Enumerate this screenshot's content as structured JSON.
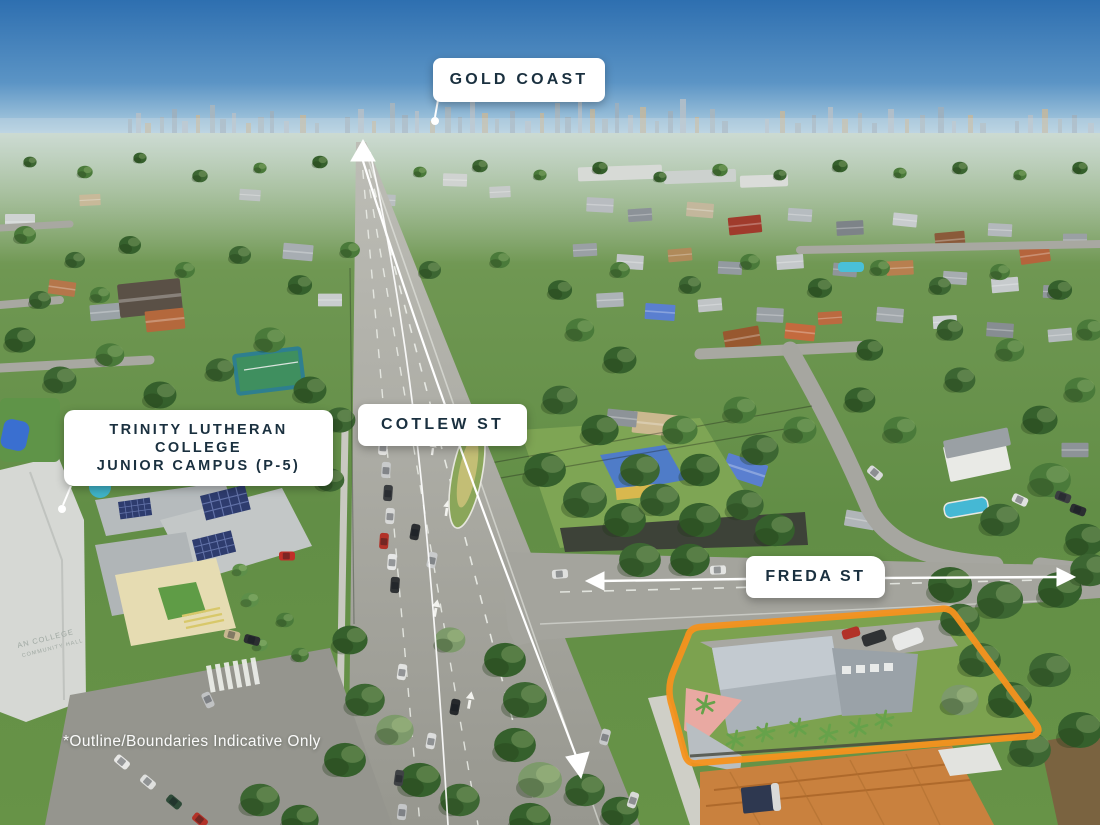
{
  "image_type": "aerial-marketing-photograph",
  "annotations": {
    "city": {
      "label": "GOLD COAST"
    },
    "main_road": {
      "label": "COTLEW ST"
    },
    "school": {
      "line1": "TRINITY LUTHERAN",
      "line2": "COLLEGE",
      "line3": "JUNIOR CAMPUS (P-5)"
    },
    "cross_street": {
      "label": "FREDA ST"
    },
    "disclaimer": "*Outline/Boundaries Indicative Only",
    "school_roof_text": {
      "line1": "AN COLLEGE",
      "line2": "COMMUNITY HALL"
    }
  },
  "colors": {
    "boundary_outline": "#F6921E",
    "label_background": "#FFFFFF",
    "label_text": "#1A303F",
    "annotation_white": "#FFFFFF",
    "sky_top": "#2E6FB0",
    "sky_horizon": "#C9DDEA"
  }
}
